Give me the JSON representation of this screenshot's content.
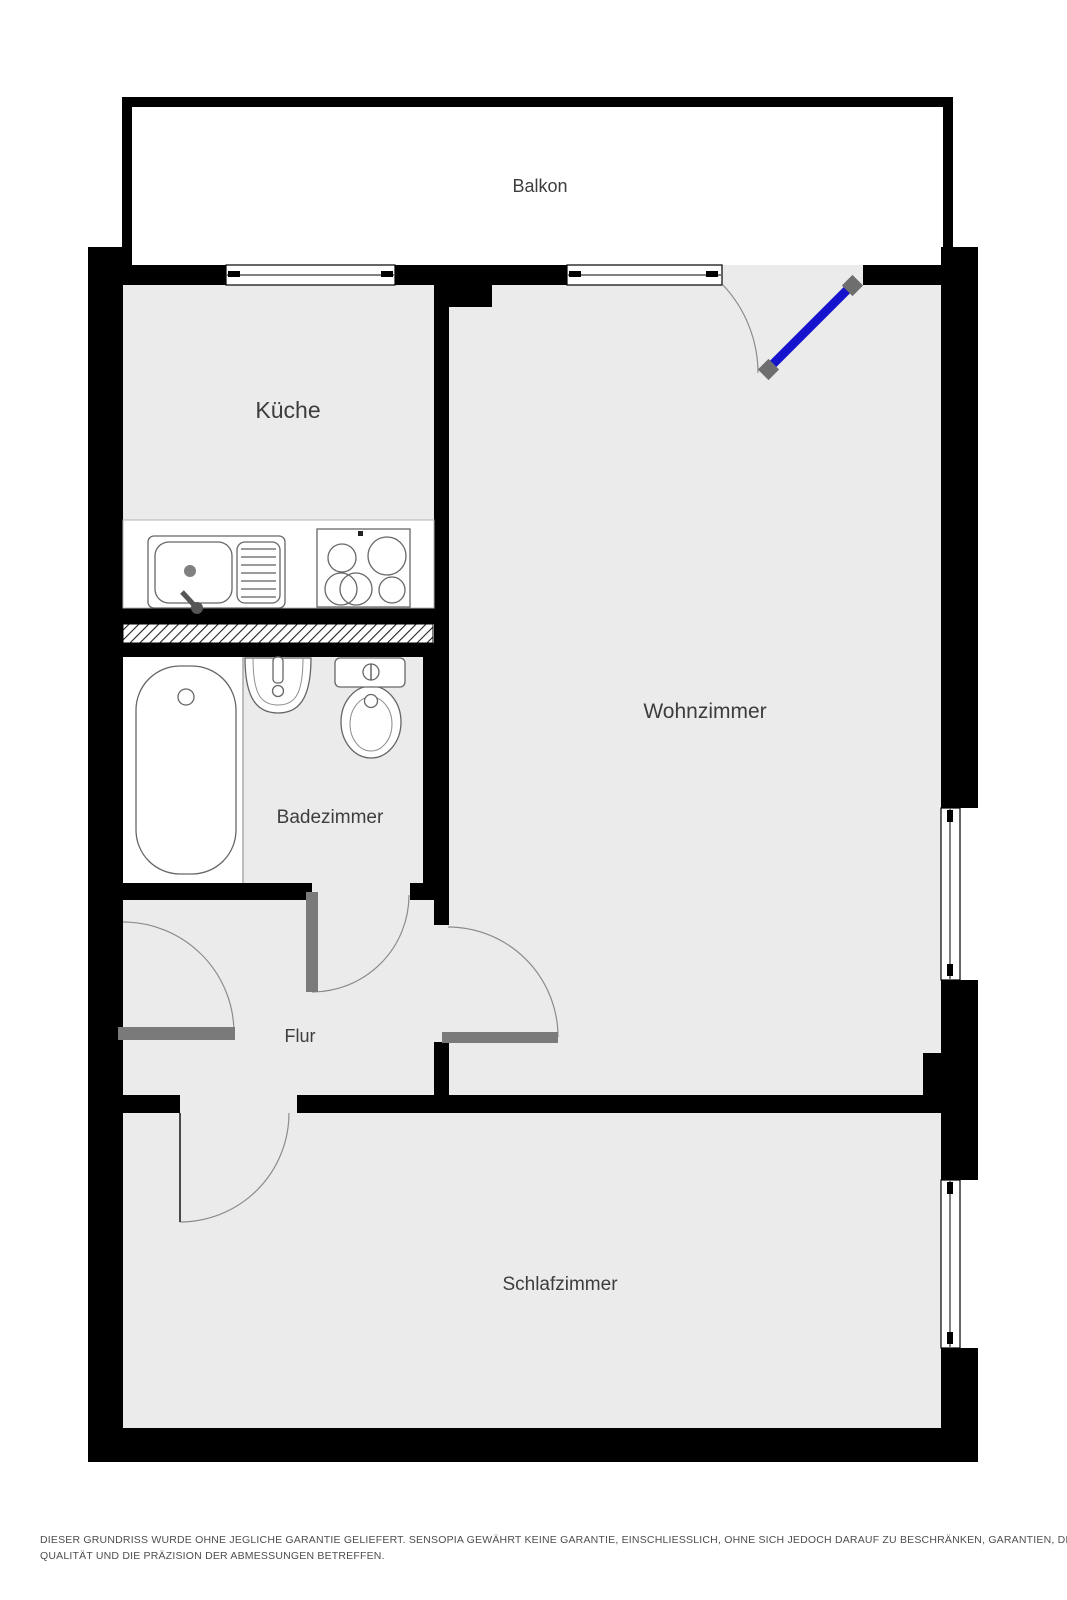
{
  "plan": {
    "type": "apartment-floor-plan",
    "rooms": [
      {
        "label": "Balkon"
      },
      {
        "label": "Küche"
      },
      {
        "label": "Wohnzimmer"
      },
      {
        "label": "Badezimmer"
      },
      {
        "label": "Flur"
      },
      {
        "label": "Schlafzimmer"
      }
    ],
    "fixtures": [
      "kitchen-sink",
      "stove",
      "bathtub",
      "bathroom-sink",
      "toilet"
    ],
    "doors": [
      "balcony-door",
      "entry-door",
      "bathroom-door",
      "livingroom-door",
      "bedroom-door"
    ],
    "windows_count": 4,
    "colors": {
      "wall": "#000000",
      "floor": "#ebebeb",
      "outside": "#ffffff",
      "interior_door_leaf": "#7a7a7a",
      "balcony_door_leaf": "#1613cd",
      "door_handle": "#6e6e6e",
      "duct_hatch": "#222222",
      "fixture_stroke": "#666666",
      "label_text": "#3d3d3d",
      "disclaimer_text": "#4e4e4e"
    }
  },
  "disclaimer": {
    "line1": "DIESER GRUNDRISS WURDE OHNE JEGLICHE GARANTIE GELIEFERT. SENSOPIA GEWÄHRT KEINE GARANTIE, EINSCHLIESSLICH, OHNE SICH JEDOCH DARAUF ZU BESCHRÄNKEN, GARANTIEN, DIE DIE",
    "line2": "QUALITÄT UND DIE PRÄZISION DER ABMESSUNGEN BETREFFEN."
  }
}
